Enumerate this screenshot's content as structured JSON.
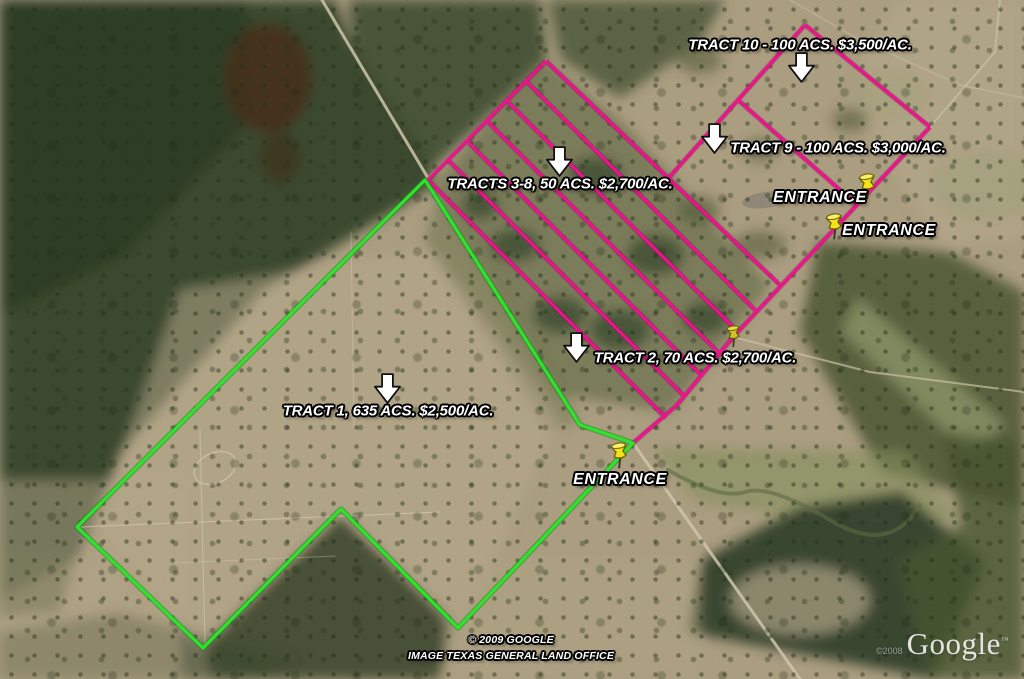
{
  "map_type": "satellite-aerial-with-land-tract-overlays",
  "tract_labels": {
    "tract10": "TRACT 10 - 100 ACS. $3,500/AC.",
    "tract9": "TRACT 9 - 100 ACS. $3,000/AC.",
    "tracts3to8": "TRACTS 3-8, 50 ACS. $2,700/AC.",
    "tract2": "TRACT 2, 70 ACS. $2,700/AC.",
    "tract1": "TRACT 1, 635 ACS. $2,500/AC."
  },
  "entrances": {
    "north": "ENTRANCE",
    "middle": "ENTRANCE",
    "south": "ENTRANCE"
  },
  "attribution": {
    "line1": "© 2009 GOOGLE",
    "line2": "IMAGE TEXAS GENERAL LAND OFFICE"
  },
  "watermark": {
    "copyright": "©2008",
    "logo": "Google",
    "tm": "™"
  },
  "icons": {
    "arrow": "down-block-arrow",
    "pin": "yellow-pushpin"
  },
  "colors": {
    "boundary_pink": "#EE128D",
    "boundary_pink_dark": "#8F0D58",
    "boundary_green": "#2EE32E",
    "boundary_green_dark": "#128A12",
    "pushpin_yellow": "#F3E11C",
    "pushpin_yellow_light": "#F9EF6E",
    "pushpin_olive": "#CFC223",
    "arrow_white": "#FFFFFF",
    "label_white": "#FFFFFF"
  }
}
